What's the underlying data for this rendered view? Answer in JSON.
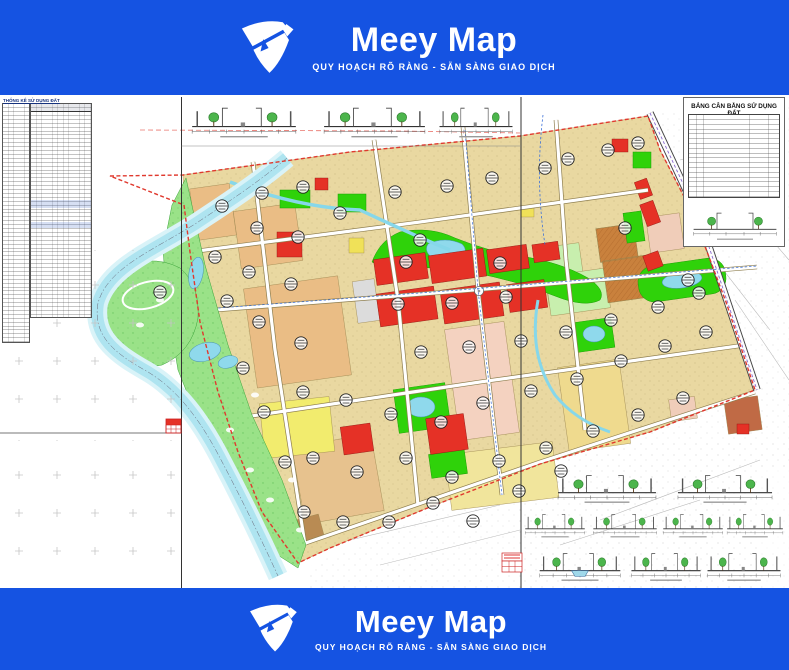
{
  "banner": {
    "title": "Meey Map",
    "tagline": "QUY HOẠCH RÕ RÀNG - SẴN SÀNG GIAO DỊCH"
  },
  "sheet": {
    "left_stats_table": {
      "title": "THỐNG KÊ SỬ DỤNG ĐẤT"
    },
    "land_balance_table": {
      "title": "BẢNG CÂN BẰNG SỬ DỤNG ĐẤT"
    }
  },
  "colors": {
    "banner_blue": "#1553e2",
    "map_tan": "#e9d8a1",
    "map_orange": "#eabd85",
    "map_pink": "#f4d2c0",
    "map_red": "#e53126",
    "map_green_bright": "#2fd20a",
    "map_green_light": "#9ae288",
    "map_green_pale": "#c8efae",
    "map_yellow": "#f2ec6e",
    "map_yellow_pale": "#efda8e",
    "water": "#aee4f0",
    "water_light": "#d9f3f8",
    "boundary_red": "#e0392e"
  }
}
